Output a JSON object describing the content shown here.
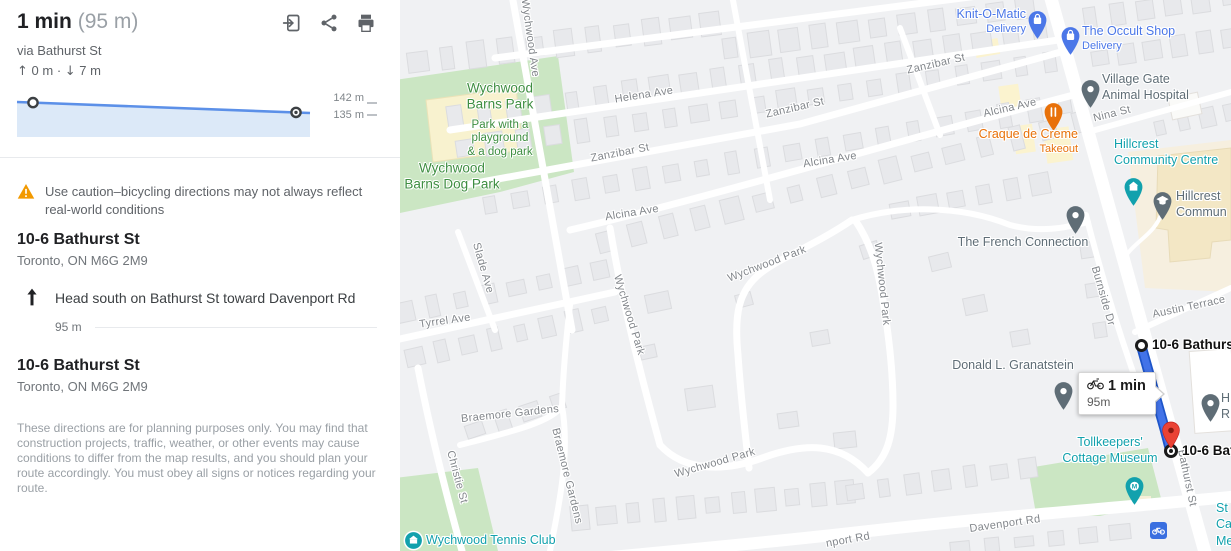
{
  "panel": {
    "header": {
      "duration": "1 min",
      "distance": "(95 m)",
      "via": "via Bathurst St",
      "ascent": "0 m",
      "descent": "7 m",
      "icons": {
        "send_to_phone": "send-to-phone-icon",
        "share": "share-icon",
        "print": "print-icon"
      }
    },
    "elevation": {
      "max_label": "142 m",
      "min_label": "135 m",
      "start_m": 142,
      "end_m": 135,
      "ascent_m": 0,
      "descent_m": 7
    },
    "warning": "Use caution–bicycling directions may not always reflect real-world conditions",
    "origin": {
      "title": "10-6 Bathurst St",
      "subtitle": "Toronto, ON M6G 2M9"
    },
    "steps": [
      {
        "instruction": "Head south on Bathurst St toward Davenport Rd",
        "distance": "95 m"
      }
    ],
    "destination": {
      "title": "10-6 Bathurst St",
      "subtitle": "Toronto, ON M6G 2M9"
    },
    "disclaimer": "These directions are for planning purposes only. You may find that construction projects, traffic, weather, or other events may cause conditions to differ from the map results, and you should plan your route accordingly. You must obey all signs or notices regarding your route."
  },
  "map": {
    "route": {
      "start_label": "10-6 Bathurst St",
      "end_label": "10-6 Bathurst St",
      "callout": {
        "duration": "1 min",
        "distance": "95m"
      }
    },
    "street_labels": [
      {
        "text": "Wychwood Ave",
        "x": 130,
        "y": 38,
        "rot": 82
      },
      {
        "text": "Helena Ave",
        "x": 244,
        "y": 95,
        "rot": -9
      },
      {
        "text": "Zanzibar St",
        "x": 220,
        "y": 153,
        "rot": -11
      },
      {
        "text": "Zanzibar St",
        "x": 395,
        "y": 108,
        "rot": -13
      },
      {
        "text": "Zanzibar St",
        "x": 536,
        "y": 64,
        "rot": -13
      },
      {
        "text": "Alcina Ave",
        "x": 232,
        "y": 213,
        "rot": -9
      },
      {
        "text": "Alcina Ave",
        "x": 430,
        "y": 160,
        "rot": -9
      },
      {
        "text": "Alcina Ave",
        "x": 610,
        "y": 108,
        "rot": -13
      },
      {
        "text": "Tyrrel Ave",
        "x": 45,
        "y": 321,
        "rot": -8
      },
      {
        "text": "Slade Ave",
        "x": 83,
        "y": 268,
        "rot": 74
      },
      {
        "text": "Wychwood Park",
        "x": 367,
        "y": 264,
        "rot": -21
      },
      {
        "text": "Wychwood Park",
        "x": 229,
        "y": 315,
        "rot": 73
      },
      {
        "text": "Wychwood Park",
        "x": 482,
        "y": 284,
        "rot": 84
      },
      {
        "text": "Wychwood Park",
        "x": 315,
        "y": 463,
        "rot": -16
      },
      {
        "text": "Braemore Gardens",
        "x": 110,
        "y": 414,
        "rot": -6
      },
      {
        "text": "Braemore Gardens",
        "x": 167,
        "y": 476,
        "rot": 76
      },
      {
        "text": "Christie St",
        "x": 57,
        "y": 477,
        "rot": 75
      },
      {
        "text": "Davenport Rd",
        "x": 605,
        "y": 524,
        "rot": -8
      },
      {
        "text": "nport Rd",
        "x": 448,
        "y": 540,
        "rot": -10
      },
      {
        "text": "Bathurst St",
        "x": 787,
        "y": 478,
        "rot": 78
      },
      {
        "text": "Burnside Dr",
        "x": 703,
        "y": 296,
        "rot": 74
      },
      {
        "text": "Austin Terrace",
        "x": 789,
        "y": 307,
        "rot": -12
      },
      {
        "text": "Nina St",
        "x": 712,
        "y": 114,
        "rot": -14
      }
    ],
    "area_labels": [
      {
        "lines": [
          "Wychwood",
          "Barns Park"
        ],
        "x": 100,
        "y": 96,
        "size": 13.5,
        "weight": 500
      },
      {
        "lines": [
          "Park with a",
          "playground",
          "& a dog park"
        ],
        "x": 100,
        "y": 139,
        "size": 11.5,
        "weight": 400
      },
      {
        "lines": [
          "Wychwood",
          "Barns Dog Park"
        ],
        "x": 52,
        "y": 176,
        "size": 13.5,
        "weight": 500
      }
    ],
    "pois": [
      {
        "name_lines": [
          "Knit-O-Matic"
        ],
        "sub_lines": [
          "Delivery"
        ],
        "color": "shop",
        "pin": "bag",
        "pin_x": 637,
        "pin_y": 20,
        "text_x": 626,
        "text_y": 6,
        "align": "right"
      },
      {
        "name_lines": [
          "The Occult Shop"
        ],
        "sub_lines": [
          "Delivery"
        ],
        "color": "shop",
        "pin": "bag",
        "pin_x": 670,
        "pin_y": 36,
        "text_x": 682,
        "text_y": 23,
        "align": "left"
      },
      {
        "name_lines": [
          "Village Gate",
          "Animal Hospital"
        ],
        "sub_lines": [],
        "color": "generic",
        "pin": "dot",
        "pin_x": 690,
        "pin_y": 89,
        "text_x": 702,
        "text_y": 71,
        "align": "left"
      },
      {
        "name_lines": [
          "Craque de Creme"
        ],
        "sub_lines": [
          "Takeout"
        ],
        "color": "food",
        "pin": "food",
        "pin_x": 653,
        "pin_y": 112,
        "text_x": 678,
        "text_y": 126,
        "align": "right"
      },
      {
        "name_lines": [
          "Hillcrest",
          "Community Centre"
        ],
        "sub_lines": [],
        "color": "civic",
        "pin": "civic",
        "pin_x": 733,
        "pin_y": 187,
        "text_x": 714,
        "text_y": 136,
        "align": "left"
      },
      {
        "name_lines": [
          "Hillcrest",
          "Commun"
        ],
        "sub_lines": [],
        "color": "generic",
        "pin": "school",
        "pin_x": 762,
        "pin_y": 201,
        "text_x": 776,
        "text_y": 188,
        "align": "left"
      },
      {
        "name_lines": [
          "The French Connection"
        ],
        "sub_lines": [],
        "color": "generic",
        "pin": "dot",
        "pin_x": 675,
        "pin_y": 215,
        "text_x": 623,
        "text_y": 234,
        "align": "center"
      },
      {
        "name_lines": [
          "Donald L. Granatstein"
        ],
        "sub_lines": [],
        "color": "generic",
        "pin": "dot",
        "pin_x": 663,
        "pin_y": 391,
        "text_x": 613,
        "text_y": 357,
        "align": "center"
      },
      {
        "name_lines": [
          "Tollkeepers'",
          "Cottage Museum"
        ],
        "sub_lines": [],
        "color": "civic",
        "pin": "museum",
        "pin_x": 734,
        "pin_y": 486,
        "text_x": 710,
        "text_y": 434,
        "align": "center"
      },
      {
        "name_lines": [
          "Wychwood Tennis Club"
        ],
        "sub_lines": [],
        "color": "civic",
        "pin": "circle",
        "pin_x": 13,
        "pin_y": 540,
        "text_x": 26,
        "text_y": 532,
        "align": "left"
      },
      {
        "name_lines": [
          "H",
          "R"
        ],
        "sub_lines": [],
        "color": "generic",
        "pin": "dot",
        "pin_x": 810,
        "pin_y": 403,
        "text_x": 821,
        "text_y": 390,
        "align": "left"
      },
      {
        "name_lines": [
          "St",
          "Ca",
          "Me"
        ],
        "sub_lines": [],
        "color": "civic",
        "pin": "none",
        "pin_x": 0,
        "pin_y": 0,
        "text_x": 816,
        "text_y": 500,
        "align": "left"
      }
    ],
    "colors": {
      "shop": "#4B77E8",
      "food": "#E8710A",
      "civic": "#12A1AD",
      "generic": "#5F6D76",
      "route_fill": "#4273E8",
      "route_casing": "#1E55C9",
      "park": "#CBE6C3",
      "street_text": "#82868b",
      "park_text": "#3e8e41",
      "dest_pin": "#EA4335"
    }
  }
}
